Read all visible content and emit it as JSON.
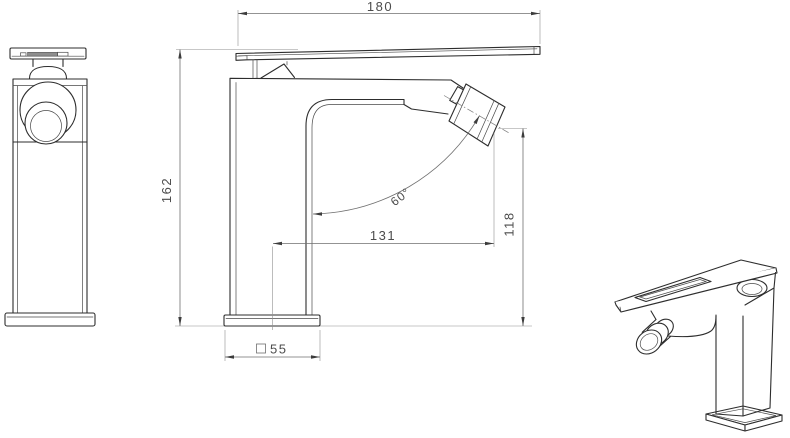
{
  "drawing": {
    "background_color": "#ffffff",
    "line_color": "#2d2d2d",
    "dimension_line_color": "#6f6f6f",
    "dimension_text_color": "#4c4c4c",
    "dimensions": {
      "overall_width": "180",
      "overall_height": "162",
      "horizontal_reach": "131",
      "outlet_height": "118",
      "outlet_angle": "60°",
      "base_square_size": "55"
    }
  }
}
